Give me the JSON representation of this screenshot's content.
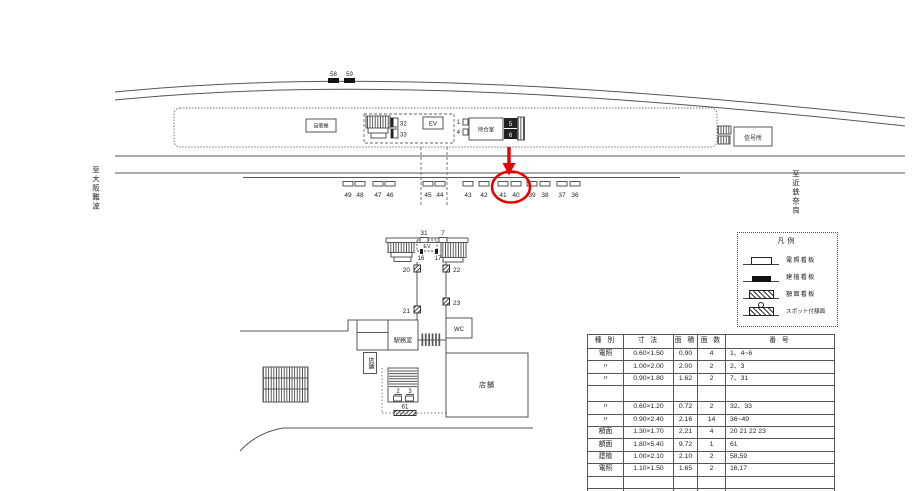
{
  "page": {
    "direction_left": "至大阪難波",
    "direction_right": "至近鉄奈良"
  },
  "platform": {
    "vending_machine": "自販機",
    "elevator": "EV",
    "waiting_room": "待合室",
    "signal_office": "信号所"
  },
  "building": {
    "elevator": "EV",
    "station_office": "駅務室",
    "toilet": "WC",
    "shop_small": "店舗",
    "shop_large": "店舗"
  },
  "nums": {
    "n58": "58",
    "n59": "59",
    "n32": "32",
    "n33": "33",
    "n1": "1",
    "n4": "4",
    "n5": "5",
    "n6": "6",
    "n31": "31",
    "n7": "7",
    "n16": "16",
    "n17": "17",
    "n20": "20",
    "n22": "22",
    "n21": "21",
    "n23": "23",
    "n2": "2",
    "n3": "3",
    "n61": "61"
  },
  "track_signs": [
    "49",
    "48",
    "47",
    "46",
    "45",
    "44",
    "43",
    "42",
    "41",
    "40",
    "39",
    "38",
    "37",
    "36"
  ],
  "legend": {
    "title": "凡例",
    "items": [
      {
        "name": "illuminated-sign",
        "label": "電照看板"
      },
      {
        "name": "erected-sign",
        "label": "建植看板"
      },
      {
        "name": "faced-sign",
        "label": "額面看板"
      },
      {
        "name": "spot-faced-sign",
        "label": "スポット付額面"
      }
    ]
  },
  "table": {
    "headers": [
      "種 別",
      "寸 法",
      "面 積",
      "面 数",
      "番 号"
    ],
    "rows": [
      [
        "電照",
        "0.60×1.50",
        "0.90",
        "4",
        "1、4~6"
      ],
      [
        "〃",
        "1.00×2.00",
        "2.00",
        "2",
        "2、3"
      ],
      [
        "〃",
        "0.90×1.80",
        "1.62",
        "2",
        "7、31"
      ],
      [
        "",
        "",
        "",
        "",
        ""
      ],
      [
        "〃",
        "0.60×1.20",
        "0.72",
        "2",
        "32、33"
      ],
      [
        "〃",
        "0.90×2.40",
        "2.16",
        "14",
        "36~49"
      ],
      [
        "額面",
        "1.30×1.70",
        "2.21",
        "4",
        "20  21  22  23"
      ],
      [
        "額面",
        "1.80×5.40",
        "9.72",
        "1",
        "61"
      ],
      [
        "建植",
        "1.00×2.10",
        "2.10",
        "2",
        "58,59"
      ],
      [
        "電照",
        "1.10×1.50",
        "1.65",
        "2",
        "16,17"
      ],
      [
        "",
        "",
        "",
        "",
        ""
      ],
      [
        "",
        "",
        "",
        "",
        ""
      ]
    ]
  },
  "colors": {
    "accent_red": "#e60000",
    "line": "#555555"
  }
}
